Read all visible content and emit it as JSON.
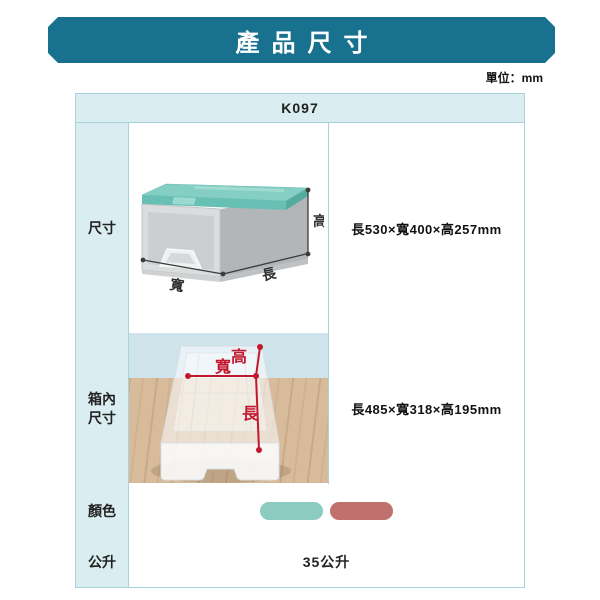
{
  "banner": {
    "title": "產品尺寸",
    "bg": "#17718f"
  },
  "unit_label": "單位：mm",
  "table": {
    "model": "K097",
    "row_dim": {
      "label": "尺寸",
      "value": "長530×寬400×高257mm"
    },
    "row_inner": {
      "label": "箱內尺寸",
      "value": "長485×寬318×高195mm"
    },
    "row_color": {
      "label": "顏色"
    },
    "row_liter": {
      "label": "公升",
      "value": "35公升"
    }
  },
  "dim_labels": {
    "height": "高",
    "width": "寬",
    "length": "長"
  },
  "swatches": [
    {
      "name": "teal",
      "hex": "#8bcbc0"
    },
    {
      "name": "rose",
      "hex": "#c0716e"
    }
  ],
  "accent": {
    "red": "#c2182e",
    "border": "#a8d2da",
    "dim_line": "#3c3c3c"
  }
}
